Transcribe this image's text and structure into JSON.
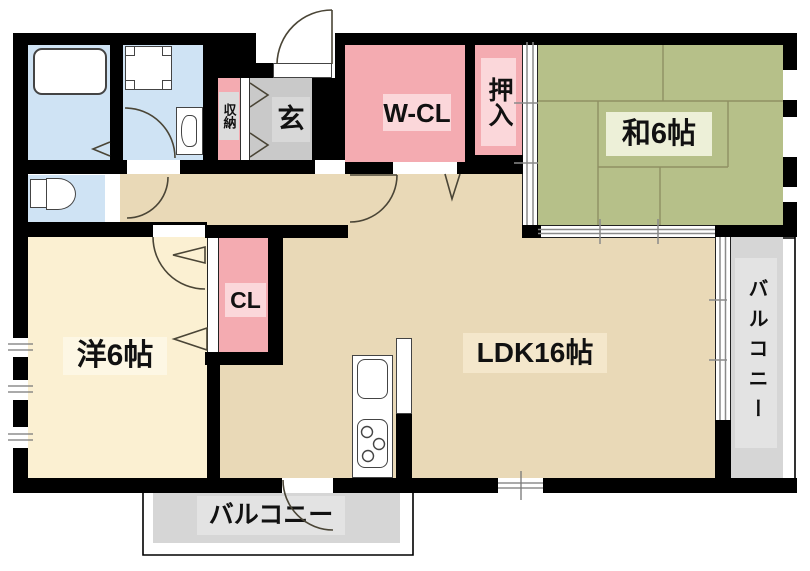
{
  "floorplan": {
    "rooms": {
      "japanese_room": "和6帖",
      "walk_in_closet": "W-CL",
      "oshiire": "押入",
      "entrance": "玄",
      "storage": "収納",
      "western_room": "洋6帖",
      "closet": "CL",
      "ldk": "LDK16帖",
      "balcony_right": "バルコニー",
      "balcony_bottom": "バルコニー"
    },
    "colors": {
      "wall": "#000000",
      "wet_area_blue": "#cfe3f4",
      "closet_pink": "#f4abb1",
      "closet_label_pink": "#fbd7da",
      "entrance_gray": "#c9c9c9",
      "tatami_green": "#b6c089",
      "ldk_beige": "#e9d9b7",
      "western_cream": "#fbf0d2",
      "balcony_gray": "#d6d6d6"
    }
  }
}
